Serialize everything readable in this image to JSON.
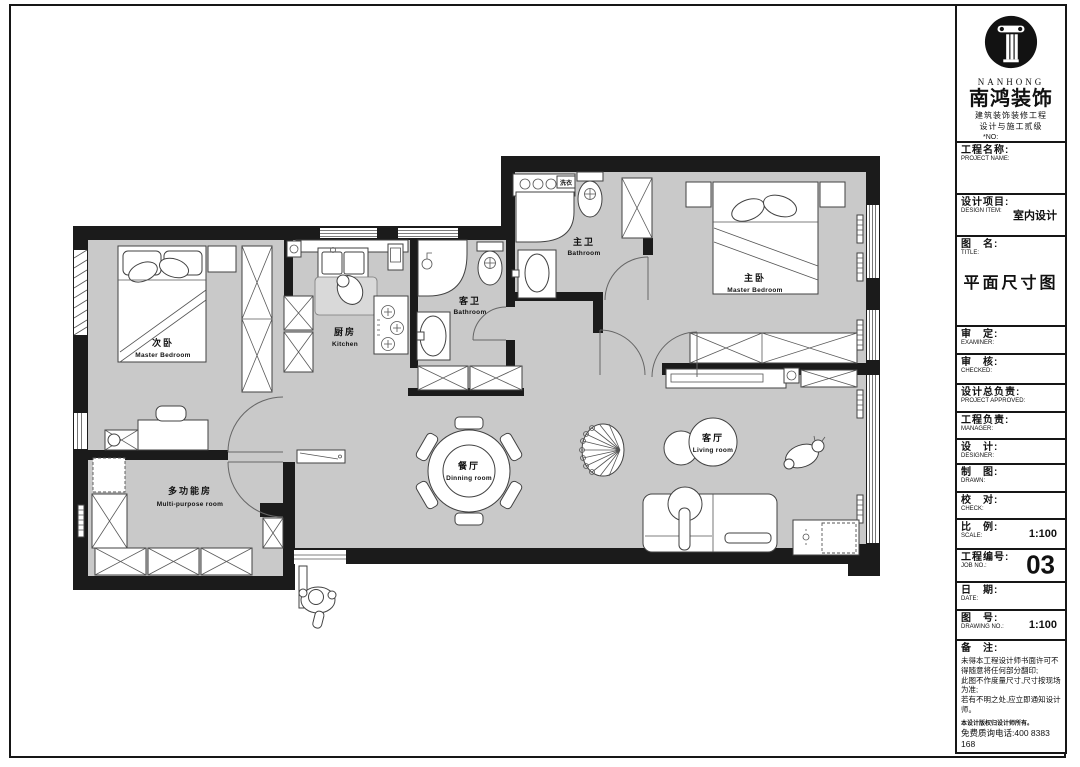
{
  "colors": {
    "wall": "#1b1b1b",
    "floor": "#c9c9c9",
    "line": "#555555",
    "sheet_border": "#161616"
  },
  "title_block": {
    "logo": {
      "brand_en": "NANHONG",
      "brand_cn": "南鸿装饰",
      "cert_line1": "建筑装饰装修工程",
      "cert_line2": "设计与施工贰级",
      "no_label": "*NO:"
    },
    "rows": [
      {
        "cn": "工程名称:",
        "en": "PROJECT NAME:",
        "value": ""
      },
      {
        "cn": "设计项目:",
        "en": "DESIGN ITEM:",
        "value": "室内设计"
      },
      {
        "cn": "图　名:",
        "en": "TITLE:",
        "value": "平面尺寸图"
      },
      {
        "cn": "审　定:",
        "en": "EXAMINER:",
        "value": ""
      },
      {
        "cn": "审　核:",
        "en": "CHECKED:",
        "value": ""
      },
      {
        "cn": "设计总负责:",
        "en": "PROJECT APPROVED:",
        "value": ""
      },
      {
        "cn": "工程负责:",
        "en": "MANAGER:",
        "value": ""
      },
      {
        "cn": "设　计:",
        "en": "DESIGNER:",
        "value": ""
      },
      {
        "cn": "制　图:",
        "en": "DRAWN:",
        "value": ""
      },
      {
        "cn": "校　对:",
        "en": "CHECK:",
        "value": ""
      },
      {
        "cn": "比　例:",
        "en": "SCALE:",
        "value": "1:100"
      },
      {
        "cn": "工程编号:",
        "en": "JOB NO.:",
        "value": "03"
      },
      {
        "cn": "日　期:",
        "en": "DATE:",
        "value": ""
      },
      {
        "cn": "图　号:",
        "en": "DRAWING NO.:",
        "value": "1:100"
      }
    ],
    "remarks": {
      "cn": "备　注:",
      "lines": [
        "未得本工程设计师书面许可不得随意将任何部分翻印;",
        "此图不作度量尺寸,尺寸按现场为准;",
        "若有不明之处,应立即通知设计师。"
      ],
      "fine_print": "本设计版权归设计师所有。",
      "phone": "免费质询电话:400 8383 168"
    }
  },
  "floor_plan": {
    "rooms": {
      "secondary_bedroom": {
        "cn": "次卧",
        "en": "Master Bedroom"
      },
      "kitchen": {
        "cn": "厨房",
        "en": "Kitchen"
      },
      "guest_bathroom": {
        "cn": "客卫",
        "en": "Bathroom"
      },
      "master_bathroom": {
        "cn": "主卫",
        "en": "Bathroom"
      },
      "master_bedroom": {
        "cn": "主卧",
        "en": "Master Bedroom"
      },
      "multi_purpose_room": {
        "cn": "多功能房",
        "en": "Multi-purpose room"
      },
      "dining_room": {
        "cn": "餐厅",
        "en": "Dinning room"
      },
      "living_room": {
        "cn": "客厅",
        "en": "Living room"
      }
    },
    "small_labels": {
      "laundry": "洗衣"
    }
  }
}
